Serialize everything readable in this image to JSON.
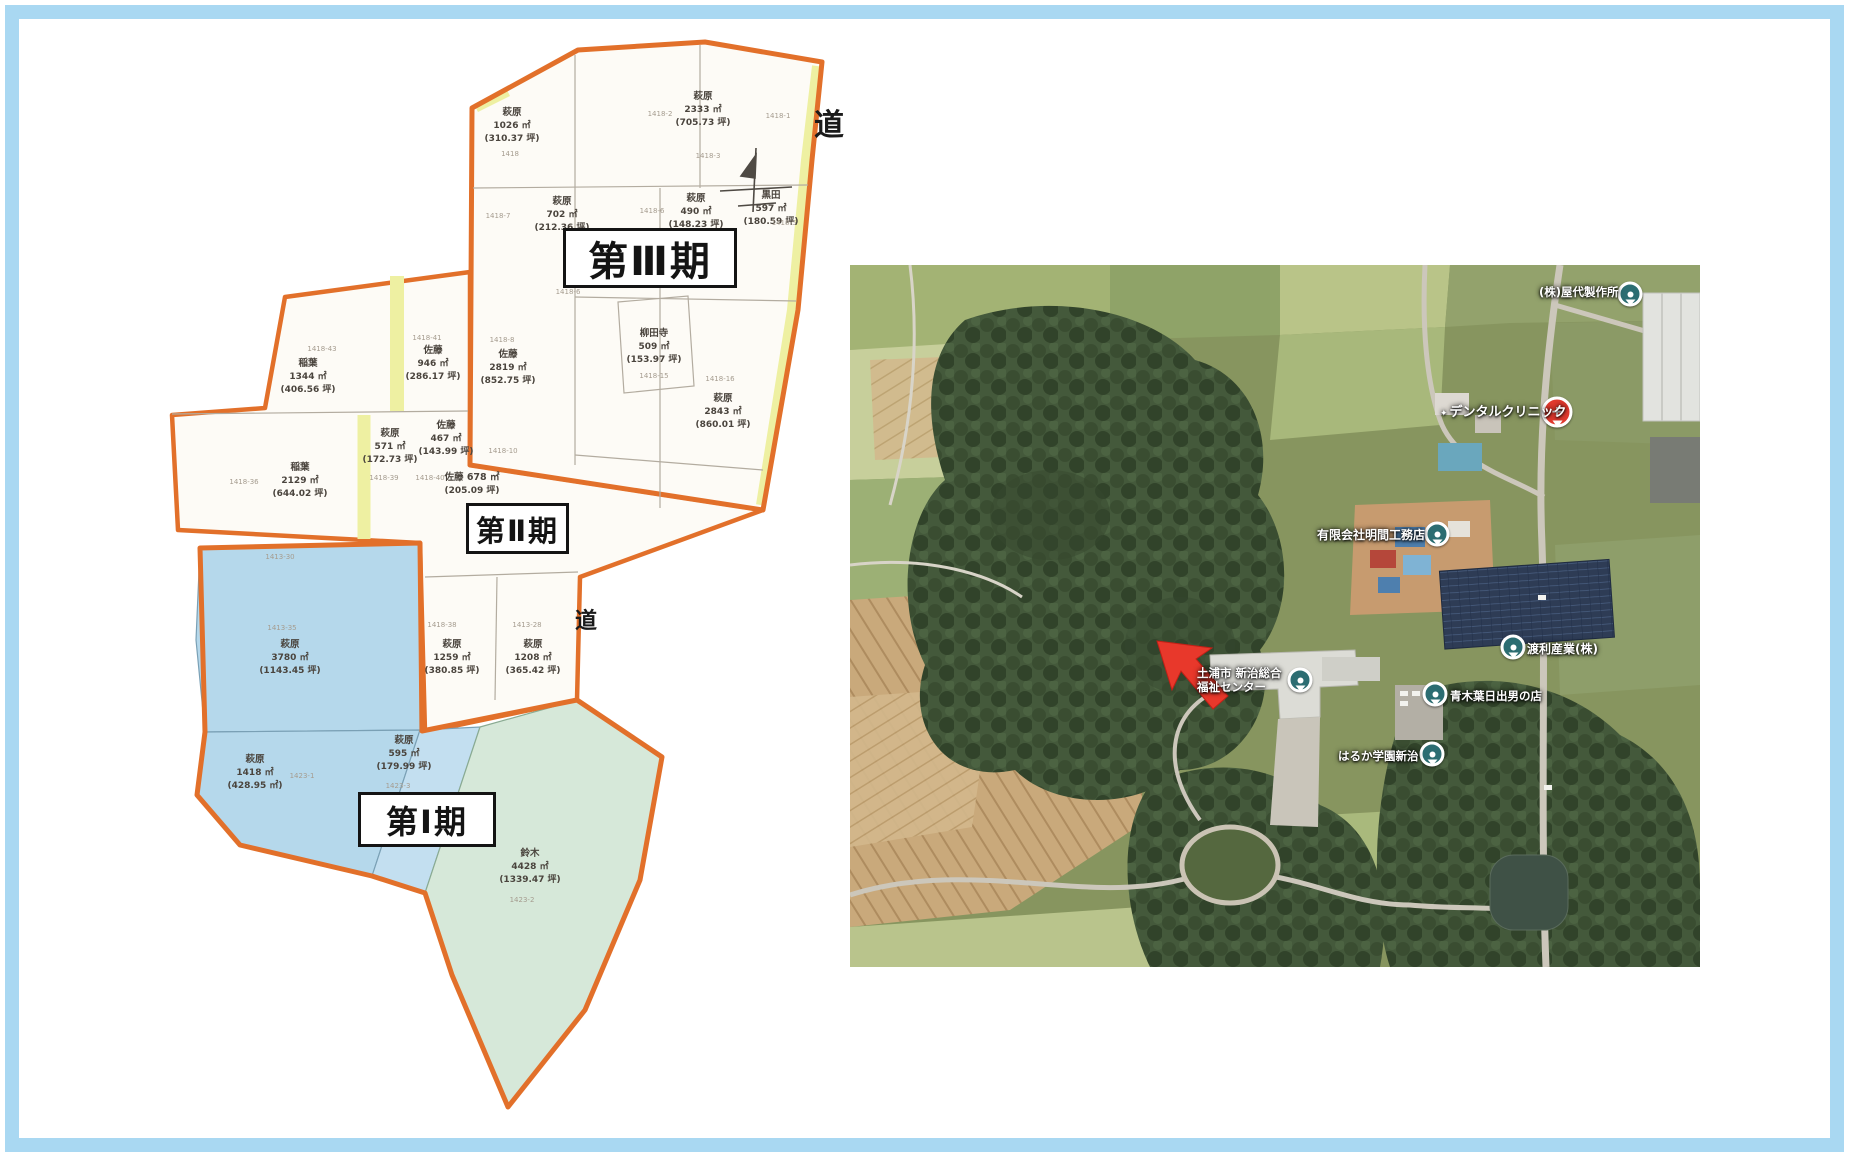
{
  "frame": {
    "border_color": "#a9d8f2"
  },
  "site_plan": {
    "phases": [
      {
        "label": "第Ⅲ期",
        "x": 563,
        "y": 228,
        "w": 168,
        "h": 54,
        "font": 40
      },
      {
        "label": "第Ⅱ期",
        "x": 466,
        "y": 503,
        "w": 97,
        "h": 45,
        "font": 29
      },
      {
        "label": "第Ⅰ期",
        "x": 358,
        "y": 792,
        "w": 132,
        "h": 49,
        "font": 32
      }
    ],
    "road_labels": [
      {
        "text": "道",
        "x": 829,
        "y": 100,
        "size": 30
      },
      {
        "text": "道",
        "x": 586,
        "y": 603,
        "size": 22
      }
    ],
    "parcels": [
      {
        "lines": [
          "萩原",
          "1026 ㎡",
          "(310.37 坪)"
        ],
        "x": 512,
        "y": 106
      },
      {
        "lines": [
          "萩原",
          "2333 ㎡",
          "(705.73 坪)"
        ],
        "x": 703,
        "y": 90
      },
      {
        "lines": [
          "萩原",
          "702 ㎡",
          "(212.36 坪)"
        ],
        "x": 562,
        "y": 195
      },
      {
        "lines": [
          "萩原",
          "490 ㎡",
          "(148.23 坪)"
        ],
        "x": 696,
        "y": 192
      },
      {
        "lines": [
          "黒田",
          "597 ㎡",
          "(180.59 坪)"
        ],
        "x": 771,
        "y": 189
      },
      {
        "lines": [
          "佐藤",
          "2819 ㎡",
          "(852.75 坪)"
        ],
        "x": 508,
        "y": 348
      },
      {
        "lines": [
          "柳田寺",
          "509 ㎡",
          "(153.97 坪)"
        ],
        "x": 654,
        "y": 327
      },
      {
        "lines": [
          "萩原",
          "2843 ㎡",
          "(860.01 坪)"
        ],
        "x": 723,
        "y": 392
      },
      {
        "lines": [
          "稲葉",
          "1344 ㎡",
          "(406.56 坪)"
        ],
        "x": 308,
        "y": 357
      },
      {
        "lines": [
          "佐藤",
          "946 ㎡",
          "(286.17 坪)"
        ],
        "x": 433,
        "y": 344
      },
      {
        "lines": [
          "萩原",
          "571 ㎡",
          "(172.73 坪)"
        ],
        "x": 390,
        "y": 427
      },
      {
        "lines": [
          "佐藤",
          "467 ㎡",
          "(143.99 坪)"
        ],
        "x": 446,
        "y": 419
      },
      {
        "lines": [
          "稲葉",
          "2129 ㎡",
          "(644.02 坪)"
        ],
        "x": 300,
        "y": 461
      },
      {
        "lines": [
          "佐藤 678 ㎡",
          "(205.09 坪)"
        ],
        "x": 472,
        "y": 471
      },
      {
        "lines": [
          "萩原",
          "3780 ㎡",
          "(1143.45 坪)"
        ],
        "x": 290,
        "y": 638
      },
      {
        "lines": [
          "萩原",
          "1259 ㎡",
          "(380.85 坪)"
        ],
        "x": 452,
        "y": 638
      },
      {
        "lines": [
          "萩原",
          "1208 ㎡",
          "(365.42 坪)"
        ],
        "x": 533,
        "y": 638
      },
      {
        "lines": [
          "萩原",
          "1418 ㎡",
          "(428.95 ㎡)"
        ],
        "x": 255,
        "y": 753
      },
      {
        "lines": [
          "萩原",
          "595 ㎡",
          "(179.99 坪)"
        ],
        "x": 404,
        "y": 734
      },
      {
        "lines": [
          "鈴木",
          "4428 ㎡",
          "(1339.47 坪)"
        ],
        "x": 530,
        "y": 847
      }
    ],
    "parcel_numbers": [
      {
        "t": "1418",
        "x": 510,
        "y": 150
      },
      {
        "t": "1418-1",
        "x": 778,
        "y": 112
      },
      {
        "t": "1418-2",
        "x": 660,
        "y": 110
      },
      {
        "t": "1418-3",
        "x": 708,
        "y": 152
      },
      {
        "t": "1418-6",
        "x": 652,
        "y": 207
      },
      {
        "t": "1418-7",
        "x": 498,
        "y": 212
      },
      {
        "t": "1418-5",
        "x": 784,
        "y": 219
      },
      {
        "t": "1418-6",
        "x": 568,
        "y": 288
      },
      {
        "t": "1418-8",
        "x": 502,
        "y": 336
      },
      {
        "t": "1418-41",
        "x": 427,
        "y": 334
      },
      {
        "t": "1418-43",
        "x": 322,
        "y": 345
      },
      {
        "t": "1418-15",
        "x": 654,
        "y": 372
      },
      {
        "t": "1418-16",
        "x": 720,
        "y": 375
      },
      {
        "t": "1418-10",
        "x": 503,
        "y": 447
      },
      {
        "t": "1418-39",
        "x": 384,
        "y": 474
      },
      {
        "t": "1418-40",
        "x": 430,
        "y": 474
      },
      {
        "t": "1418-36",
        "x": 244,
        "y": 478
      },
      {
        "t": "1413-30",
        "x": 280,
        "y": 553
      },
      {
        "t": "1413-35",
        "x": 282,
        "y": 624
      },
      {
        "t": "1418-38",
        "x": 442,
        "y": 621
      },
      {
        "t": "1413-28",
        "x": 527,
        "y": 621
      },
      {
        "t": "1423-1",
        "x": 302,
        "y": 772
      },
      {
        "t": "1423-3",
        "x": 398,
        "y": 782
      },
      {
        "t": "1423-2",
        "x": 522,
        "y": 896
      }
    ],
    "colors": {
      "boundary_orange": "#e2702a",
      "strip_yellow": "#eef0a2",
      "parcel_blue": "#b5d8eb",
      "parcel_green": "#d6e8d9",
      "parcel_white": "#fdfbf6"
    }
  },
  "aerial_map": {
    "labels": [
      {
        "lines": [
          "(株)屋代製作所"
        ],
        "x": 1539,
        "y": 286,
        "size": 11.5,
        "marker": "teal",
        "mx": 1630,
        "my": 294
      },
      {
        "lines": [
          "デンタルクリニック"
        ],
        "x": 1440,
        "y": 405,
        "size": 13,
        "icon": "✦",
        "marker": "red",
        "mx": 1557,
        "my": 412
      },
      {
        "lines": [
          "有限会社明間工務店"
        ],
        "x": 1317,
        "y": 528,
        "size": 12,
        "marker": "teal",
        "mx": 1437,
        "my": 534
      },
      {
        "lines": [
          "渡利産業(株)"
        ],
        "x": 1527,
        "y": 642,
        "size": 12,
        "marker": "teal",
        "mx": 1513,
        "my": 647
      },
      {
        "lines": [
          "土浦市 新治総合",
          "福祉センター"
        ],
        "x": 1197,
        "y": 667,
        "size": 11.5,
        "marker": "teal",
        "mx": 1300,
        "my": 680
      },
      {
        "lines": [
          "青木葉日出男の店"
        ],
        "x": 1450,
        "y": 690,
        "size": 11.5,
        "marker": "teal",
        "mx": 1435,
        "my": 694
      },
      {
        "lines": [
          "はるか学園新治"
        ],
        "x": 1338,
        "y": 750,
        "size": 11.5,
        "marker": "teal",
        "mx": 1432,
        "my": 754
      }
    ],
    "arrow_color": "#e8382b",
    "marker_red_glyph": "+"
  }
}
